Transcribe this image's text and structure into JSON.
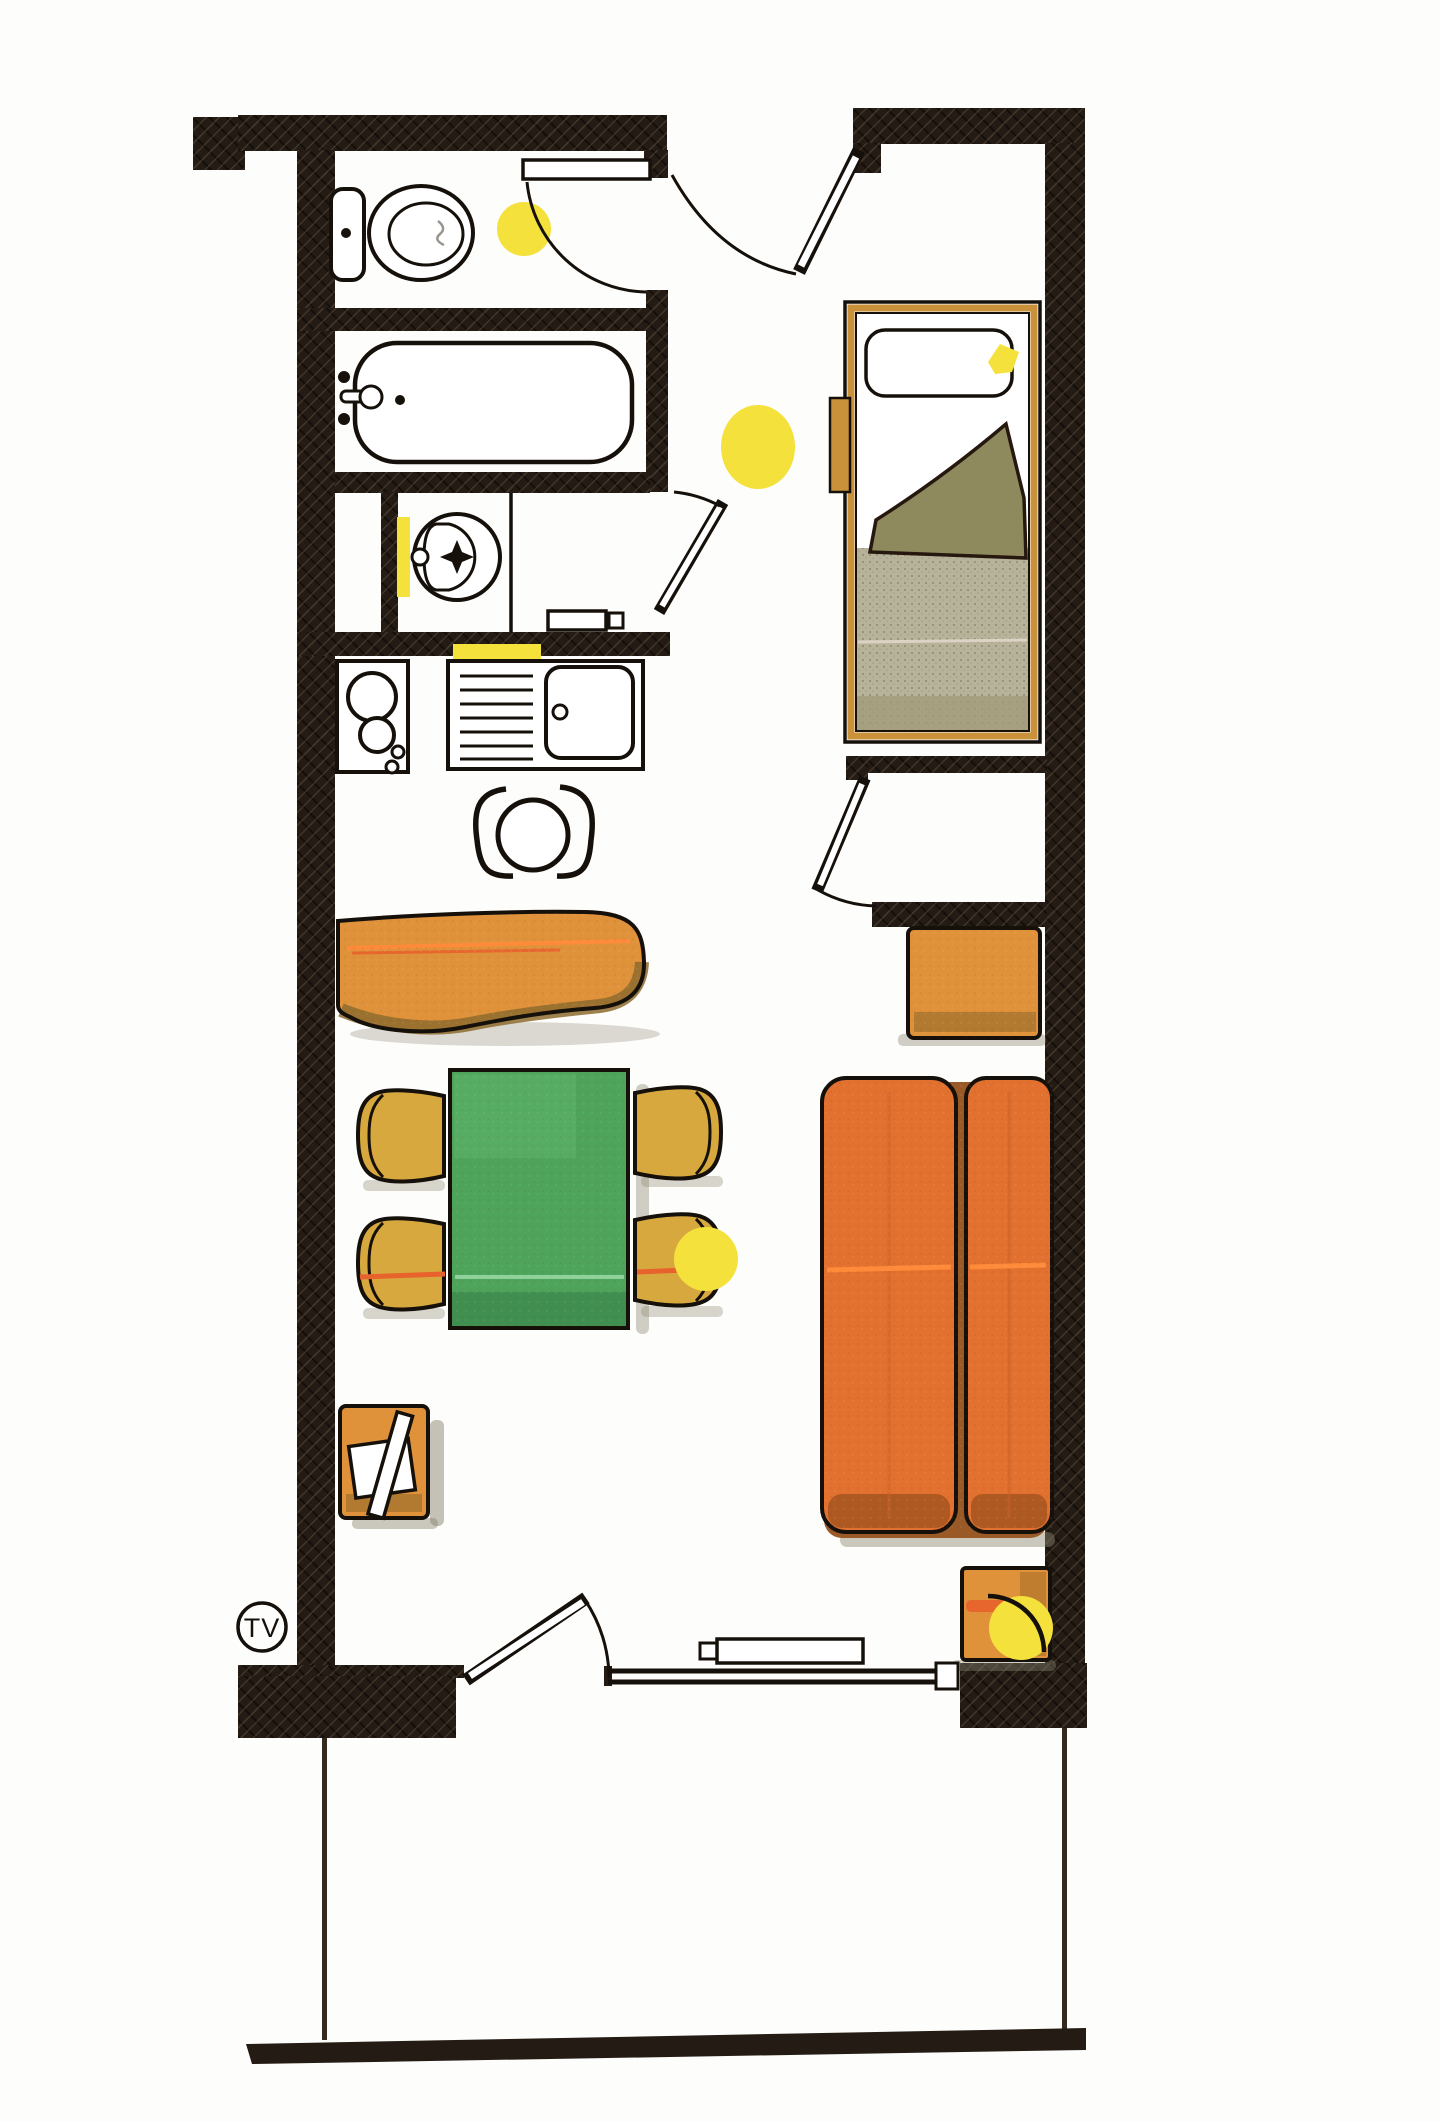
{
  "document": {
    "kind": "floor-plan",
    "style": "hand-drawn marker sketch"
  },
  "legend": {
    "tv_label": "TV"
  },
  "palette": {
    "wall": "#241c14",
    "floor": "#fdfdfb",
    "furniture_orange": "#e0923b",
    "bed_orange": "#e2702f",
    "accent_orange_line": "#ff8a3a",
    "accent_red_line": "#e8622d",
    "chair_gold": "#d7a83e",
    "table_green": "#4fa45c",
    "bed_frame_tan": "#c8913a",
    "blanket_olive": "#8f8a5e",
    "bedding_khaki": "#b7b29a",
    "light_yellow": "#f4e13c"
  },
  "fixtures": [
    {
      "name": "toilet",
      "area": "wc"
    },
    {
      "name": "bathtub",
      "area": "bathroom"
    },
    {
      "name": "washbasin",
      "area": "bathroom"
    },
    {
      "name": "cooktop-two-burners",
      "area": "kitchenette"
    },
    {
      "name": "kitchen-sink-with-drainboard",
      "area": "kitchenette"
    },
    {
      "name": "stool",
      "area": "kitchenette"
    },
    {
      "name": "bench-sofa",
      "area": "living"
    },
    {
      "name": "dining-table",
      "area": "living"
    },
    {
      "name": "chair",
      "area": "living",
      "count": 4
    },
    {
      "name": "single-bed",
      "area": "sleeping"
    },
    {
      "name": "double-bed",
      "area": "sleeping"
    },
    {
      "name": "side-table",
      "count": 3
    },
    {
      "name": "tv-set",
      "area": "living"
    },
    {
      "name": "radiator",
      "area": "living"
    },
    {
      "name": "ceiling-light",
      "count": 5
    },
    {
      "name": "balcony",
      "area": "exterior"
    }
  ],
  "doors": [
    {
      "name": "entrance-door",
      "state": "open"
    },
    {
      "name": "wc-door",
      "state": "open-against-wall"
    },
    {
      "name": "bathroom-door",
      "state": "ajar"
    },
    {
      "name": "room-divider-door",
      "state": "open"
    },
    {
      "name": "balcony-door",
      "state": "open"
    }
  ]
}
